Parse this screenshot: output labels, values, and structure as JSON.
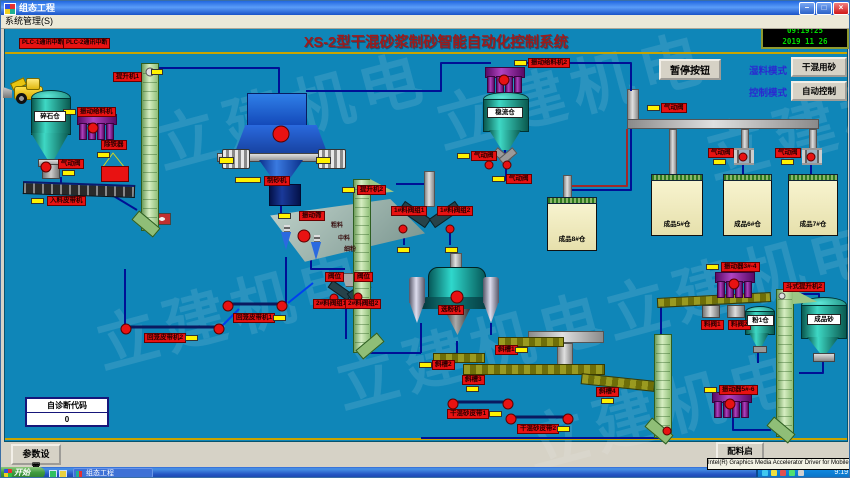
{
  "window": {
    "title": "组态工程",
    "menu": "系统管理(S)"
  },
  "header": {
    "plc_alarms": [
      "PLC-1通讯中断",
      "PLC-2通讯中断"
    ],
    "title": "XS-2型干混砂浆制砂智能自动化控制系统"
  },
  "clock": {
    "time": "09:19:25",
    "date": "2019   11   26"
  },
  "controls": {
    "pause": "暂停按钮",
    "mode1_label": "湿料模式",
    "mode1_value": "干混用砂",
    "mode2_label": "控制模式",
    "mode2_value": "自动控制"
  },
  "diagnostic": {
    "label": "自诊断代码",
    "value": "0"
  },
  "bottom": {
    "param_btn": "参数设置",
    "batch_btn": "配料启停",
    "tooltip": "Intel(R) Graphics Media Accelerator Driver for Mobile"
  },
  "taskbar": {
    "start": "开始",
    "task": "组态工程",
    "time": "9:19"
  },
  "watermark": "立建机电",
  "colors": {
    "canvas": "#0F86B8",
    "label_red": "#E81212",
    "indicator_yellow": "#FFF200",
    "line_navy": "#001095",
    "lcd_green": "#00DD00",
    "title_red": "#9E1A1A"
  },
  "labels": [
    {
      "t": "提升机1",
      "x": 112,
      "y": 71
    },
    {
      "t": "振动给料机",
      "x": 76,
      "y": 106,
      "ix": 62,
      "iy": 108
    },
    {
      "t": "除铁器",
      "x": 100,
      "y": 139,
      "ix": 96,
      "iy": 151
    },
    {
      "t": "气动阀",
      "x": 57,
      "y": 158,
      "ix": 61,
      "iy": 169
    },
    {
      "t": "入料皮带机",
      "x": 46,
      "y": 195,
      "ix": 30,
      "iy": 197
    },
    {
      "t": "制砂机",
      "x": 263,
      "y": 175,
      "ix": 234,
      "iy": 176,
      "iw": 26
    },
    {
      "t": "振动筛",
      "x": 298,
      "y": 210,
      "ix": 277,
      "iy": 212
    },
    {
      "t": "提升机2",
      "x": 356,
      "y": 184,
      "ix": 341,
      "iy": 186
    },
    {
      "t": "1#料阀组1",
      "x": 390,
      "y": 205,
      "ix": 396,
      "iy": 246
    },
    {
      "t": "1#料阀组2",
      "x": 436,
      "y": 205,
      "ix": 444,
      "iy": 246
    },
    {
      "t": "阀位",
      "x": 324,
      "y": 271
    },
    {
      "t": "阀位",
      "x": 353,
      "y": 271
    },
    {
      "t": "2#料阀组1",
      "x": 312,
      "y": 298
    },
    {
      "t": "2#料阀组2",
      "x": 344,
      "y": 298
    },
    {
      "t": "选粉机",
      "x": 437,
      "y": 304
    },
    {
      "t": "振动给料机2",
      "x": 527,
      "y": 57,
      "ix": 513,
      "iy": 59
    },
    {
      "t": "气动阀",
      "x": 470,
      "y": 150,
      "ix": 456,
      "iy": 152
    },
    {
      "t": "气动阀",
      "x": 505,
      "y": 173,
      "ix": 491,
      "iy": 175
    },
    {
      "t": "气动阀",
      "x": 660,
      "y": 102,
      "ix": 646,
      "iy": 104
    },
    {
      "t": "气动阀",
      "x": 707,
      "y": 147,
      "ix": 712,
      "iy": 158
    },
    {
      "t": "气动阀",
      "x": 774,
      "y": 147,
      "ix": 780,
      "iy": 158
    },
    {
      "t": "斜槽1",
      "x": 494,
      "y": 344,
      "ix": 514,
      "iy": 346
    },
    {
      "t": "斜槽2",
      "x": 431,
      "y": 359,
      "ix": 418,
      "iy": 361
    },
    {
      "t": "斜槽3",
      "x": 461,
      "y": 374,
      "ix": 465,
      "iy": 385
    },
    {
      "t": "斜槽4",
      "x": 595,
      "y": 386,
      "ix": 600,
      "iy": 397
    },
    {
      "t": "干混砂皮带1",
      "x": 446,
      "y": 408,
      "ix": 488,
      "iy": 410
    },
    {
      "t": "干混砂皮带2",
      "x": 516,
      "y": 423,
      "ix": 556,
      "iy": 425
    },
    {
      "t": "回笼皮带机1",
      "x": 232,
      "y": 312,
      "ix": 272,
      "iy": 314
    },
    {
      "t": "回笼皮带机2",
      "x": 143,
      "y": 332,
      "ix": 184,
      "iy": 334
    },
    {
      "t": "振动器3#-4",
      "x": 720,
      "y": 261,
      "ix": 705,
      "iy": 263
    },
    {
      "t": "振动器5#-6",
      "x": 718,
      "y": 384,
      "ix": 703,
      "iy": 386
    },
    {
      "t": "料阀1",
      "x": 700,
      "y": 319
    },
    {
      "t": "料阀2",
      "x": 727,
      "y": 319
    },
    {
      "t": "斗式提升机2",
      "x": 782,
      "y": 281
    }
  ],
  "white_labels": [
    {
      "t": "碎石仓",
      "x": 33,
      "y": 110,
      "w": 30
    },
    {
      "t": "稳流仓",
      "x": 486,
      "y": 106,
      "w": 34
    },
    {
      "t": "粉1仓",
      "x": 746,
      "y": 314,
      "w": 25
    },
    {
      "t": "成品砂",
      "x": 806,
      "y": 313,
      "w": 32
    }
  ],
  "silos": [
    {
      "t": "成品8#仓",
      "x": 546,
      "y": 200,
      "w": 48,
      "h": 48
    },
    {
      "t": "成品5#仓",
      "x": 650,
      "y": 177,
      "w": 50,
      "h": 56
    },
    {
      "t": "成品6#仓",
      "x": 722,
      "y": 177,
      "w": 47,
      "h": 56
    },
    {
      "t": "成品7#仓",
      "x": 787,
      "y": 177,
      "w": 48,
      "h": 56
    }
  ],
  "small_texts": [
    {
      "t": "粗料",
      "x": 330,
      "y": 222
    },
    {
      "t": "中料",
      "x": 337,
      "y": 235
    },
    {
      "t": "细粉",
      "x": 343,
      "y": 246
    }
  ],
  "lines": [
    {
      "c": "n",
      "p": [
        [
          155,
          67
        ],
        [
          278,
          67
        ],
        [
          278,
          92
        ]
      ]
    },
    {
      "c": "n",
      "p": [
        [
          60,
          176
        ],
        [
          60,
          186
        ]
      ]
    },
    {
      "c": "n",
      "p": [
        [
          106,
          191
        ],
        [
          136,
          209
        ]
      ]
    },
    {
      "c": "n",
      "p": [
        [
          280,
          198
        ],
        [
          280,
          212
        ]
      ]
    },
    {
      "c": "n",
      "p": [
        [
          395,
          183
        ],
        [
          425,
          183
        ],
        [
          425,
          203
        ]
      ]
    },
    {
      "c": "n",
      "p": [
        [
          504,
          146
        ],
        [
          504,
          157
        ]
      ]
    },
    {
      "c": "n",
      "p": [
        [
          310,
          256
        ],
        [
          310,
          268
        ],
        [
          344,
          268
        ]
      ]
    },
    {
      "c": "n",
      "p": [
        [
          285,
          256
        ],
        [
          285,
          302
        ]
      ]
    },
    {
      "c": "n",
      "p": [
        [
          124,
          268
        ],
        [
          124,
          325
        ]
      ]
    },
    {
      "c": "n",
      "p": [
        [
          305,
          90
        ],
        [
          440,
          90
        ],
        [
          440,
          62
        ],
        [
          490,
          62
        ]
      ]
    },
    {
      "c": "n",
      "p": [
        [
          522,
          62
        ],
        [
          630,
          62
        ],
        [
          630,
          90
        ]
      ]
    },
    {
      "c": "n",
      "p": [
        [
          366,
          352
        ],
        [
          420,
          352
        ]
      ]
    },
    {
      "c": "n",
      "p": [
        [
          420,
          322
        ],
        [
          420,
          352
        ]
      ]
    },
    {
      "c": "n",
      "p": [
        [
          490,
          322
        ],
        [
          490,
          334
        ]
      ]
    },
    {
      "c": "n",
      "p": [
        [
          420,
          437
        ],
        [
          660,
          437
        ]
      ]
    },
    {
      "c": "n",
      "p": [
        [
          822,
          358
        ],
        [
          822,
          372
        ],
        [
          798,
          372
        ]
      ]
    },
    {
      "c": "n",
      "p": [
        [
          757,
          349
        ],
        [
          757,
          362
        ]
      ]
    },
    {
      "c": "n",
      "p": [
        [
          797,
          293
        ],
        [
          818,
          293
        ],
        [
          818,
          301
        ]
      ]
    },
    {
      "c": "n",
      "p": [
        [
          732,
          413
        ],
        [
          732,
          429
        ],
        [
          770,
          429
        ]
      ]
    },
    {
      "c": "n",
      "p": [
        [
          456,
          340
        ],
        [
          456,
          360
        ]
      ]
    },
    {
      "c": "n",
      "p": [
        [
          345,
          308
        ],
        [
          345,
          338
        ]
      ]
    },
    {
      "c": "n",
      "p": [
        [
          403,
          232
        ],
        [
          403,
          244
        ]
      ]
    },
    {
      "c": "n",
      "p": [
        [
          449,
          232
        ],
        [
          449,
          244
        ]
      ]
    },
    {
      "c": "n",
      "p": [
        [
          505,
          168
        ],
        [
          505,
          180
        ]
      ]
    },
    {
      "c": "n",
      "p": [
        [
          742,
          162
        ],
        [
          742,
          176
        ]
      ]
    },
    {
      "c": "n",
      "p": [
        [
          810,
          162
        ],
        [
          810,
          176
        ]
      ]
    },
    {
      "c": "n",
      "p": [
        [
          571,
          189
        ],
        [
          630,
          189
        ],
        [
          630,
          128
        ]
      ]
    },
    {
      "c": "n",
      "p": [
        [
          660,
          300
        ],
        [
          660,
          333
        ]
      ]
    },
    {
      "c": "b",
      "p": [
        [
          220,
          326
        ],
        [
          238,
          308
        ]
      ]
    },
    {
      "c": "b",
      "p": [
        [
          287,
          302
        ],
        [
          312,
          282
        ]
      ]
    },
    {
      "c": "r",
      "p": [
        [
          571,
          185
        ],
        [
          626,
          185
        ],
        [
          626,
          128
        ]
      ]
    },
    {
      "c": "k",
      "p": [
        [
          227,
          303
        ],
        [
          281,
          303
        ]
      ]
    },
    {
      "c": "k",
      "p": [
        [
          125,
          326
        ],
        [
          218,
          326
        ]
      ]
    },
    {
      "c": "k",
      "p": [
        [
          452,
          401
        ],
        [
          507,
          401
        ]
      ]
    },
    {
      "c": "k",
      "p": [
        [
          510,
          416
        ],
        [
          567,
          416
        ]
      ]
    },
    {
      "c": "y",
      "p": [
        [
          101,
          167
        ],
        [
          112,
          152
        ],
        [
          124,
          167
        ]
      ]
    }
  ],
  "circles": [
    [
      45,
      166,
      5
    ],
    [
      92,
      127,
      5
    ],
    [
      280,
      133,
      8
    ],
    [
      303,
      235,
      6
    ],
    [
      456,
      296,
      6
    ],
    [
      503,
      79,
      5
    ],
    [
      227,
      305,
      5
    ],
    [
      281,
      305,
      5
    ],
    [
      125,
      328,
      5
    ],
    [
      218,
      328,
      5
    ],
    [
      452,
      403,
      5
    ],
    [
      507,
      403,
      5
    ],
    [
      510,
      418,
      5
    ],
    [
      567,
      418,
      5
    ],
    [
      488,
      164,
      4
    ],
    [
      506,
      164,
      4
    ],
    [
      402,
      228,
      4
    ],
    [
      449,
      228,
      4
    ],
    [
      333,
      297,
      4
    ],
    [
      357,
      296,
      4
    ],
    [
      742,
      156,
      4
    ],
    [
      810,
      156,
      4
    ],
    [
      733,
      283,
      5
    ],
    [
      729,
      403,
      5
    ],
    [
      666,
      430,
      4
    ],
    [
      149,
      71,
      4,
      "#e0e0e0"
    ],
    [
      361,
      190,
      3,
      "#dfeadb"
    ],
    [
      781,
      295,
      3,
      "#e0e0e0"
    ]
  ],
  "yellow_boxes": [
    [
      150,
      68,
      12,
      6
    ],
    [
      218,
      156,
      15,
      7
    ],
    [
      315,
      156,
      15,
      7
    ]
  ],
  "purples": [
    [
      76,
      113
    ],
    [
      484,
      66
    ],
    [
      714,
      271
    ],
    [
      711,
      391
    ]
  ],
  "elevators": [
    {
      "x": 140,
      "y": 62,
      "h": 168,
      "head": 0,
      "foot": -1
    },
    {
      "x": 352,
      "y": 178,
      "h": 174,
      "head": 1,
      "foot": 1
    },
    {
      "x": 775,
      "y": 288,
      "h": 148,
      "head": 1,
      "foot": -1
    },
    {
      "x": 653,
      "y": 333,
      "h": 104,
      "head": 0,
      "foot": -1
    }
  ],
  "olive_bars": [
    [
      656,
      294,
      112,
      8,
      -3
    ],
    [
      497,
      336,
      64,
      8,
      0
    ],
    [
      432,
      352,
      50,
      8,
      0
    ],
    [
      462,
      363,
      140,
      9,
      0
    ],
    [
      580,
      376,
      72,
      9,
      6
    ]
  ],
  "gray_pipes": [
    [
      626,
      88,
      12,
      38
    ],
    [
      626,
      118,
      192,
      10
    ],
    [
      668,
      128,
      8,
      50
    ],
    [
      740,
      128,
      8,
      22
    ],
    [
      808,
      128,
      8,
      22
    ],
    [
      562,
      174,
      9,
      30
    ],
    [
      527,
      330,
      76,
      12
    ],
    [
      556,
      342,
      16,
      26
    ],
    [
      449,
      252,
      12,
      16
    ]
  ],
  "watermarks": [
    [
      150,
      60
    ],
    [
      430,
      40
    ],
    [
      90,
      260
    ],
    [
      330,
      300
    ],
    [
      600,
      230
    ],
    [
      700,
      70
    ],
    [
      520,
      360
    ]
  ]
}
